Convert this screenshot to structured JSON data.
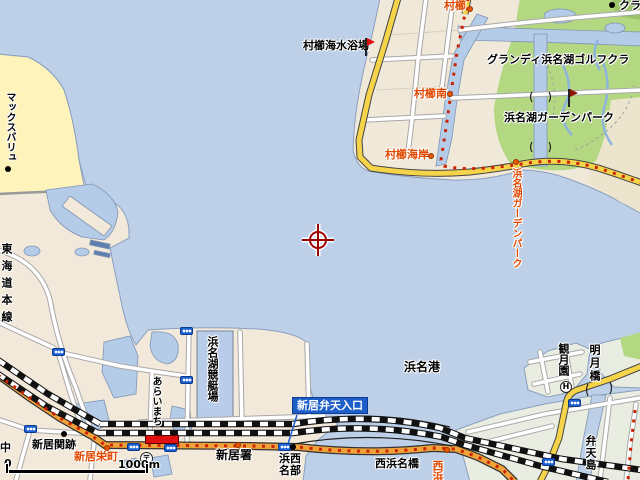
{
  "map_type": "street-map",
  "labels": {
    "murakushi_beach": "村櫛海水浴場",
    "murakushi": "村櫛",
    "murakushi_minami": "村櫛南",
    "murakushi_kaigan": "村櫛海岸",
    "grandee_golf": "グランディ浜名湖ゴルフクラ",
    "clubhouse": "クラ",
    "garden_park": "浜名湖ガーデンパーク",
    "garden_park_stop": "浜名湖ガーデンパーク",
    "max_valu": "マックスバリュ",
    "tokaido_line": "東海道本線",
    "kyoteijo": "浜名湖競艇場",
    "araimachi": "あらいまち",
    "arai_sekiato": "新居関跡",
    "arai_sakaemachi": "新居栄町",
    "naka": "中",
    "arai_police": "新居署",
    "benten_sign": "新居弁天入口",
    "nishi_hamana_bridge": "西浜名橋",
    "hamana_seibu_row1": "浜西",
    "hamana_seibu_row2": "名部",
    "hamana_port": "浜名港",
    "kangetsuen": "観月園",
    "meigetsu_bridge": "明月橋",
    "bentenjima": "弁天島",
    "nishihama_stop": "西浜",
    "postal_mark": "〒",
    "hotel_mark": "H"
  },
  "scale_bar": {
    "start": "0",
    "end": "1000m"
  },
  "colors": {
    "water": "#bdd0e8",
    "land": "#f2e9db",
    "island_land": "#e9ece0",
    "park_green": "#b4d882",
    "commercial_yellow": "#fdf3bb",
    "road_yellow": "#f6d44a",
    "road_orange": "#f0a23a",
    "bus_route_red": "#cc2200",
    "label_red": "#e04800",
    "station_red": "#e01010",
    "sign_blue": "#1e5ec8",
    "signal_blue": "#1f62d6",
    "center_marker_red": "#9c0000"
  }
}
